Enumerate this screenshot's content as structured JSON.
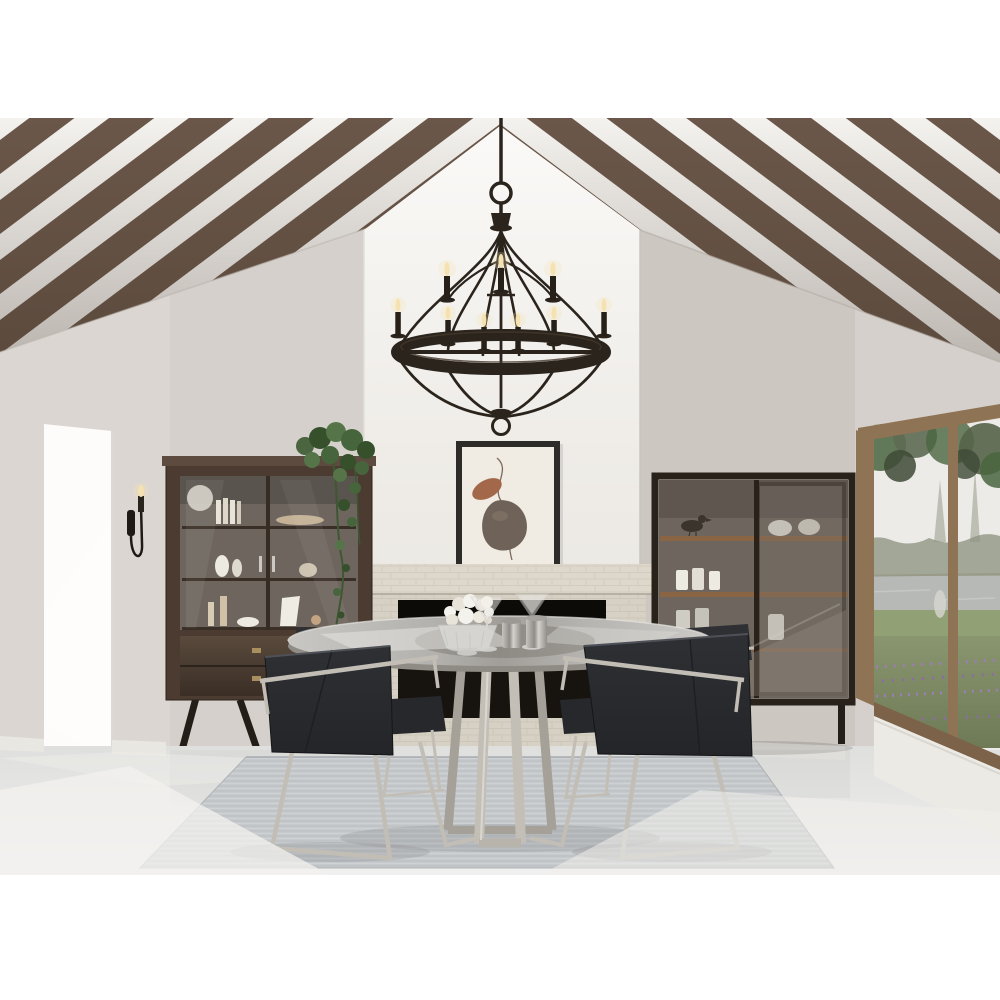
{
  "image": {
    "kind": "product-lifestyle-photo",
    "subject": "Modern farmhouse dining room with a 9-light wrought-iron candle chandelier over a round glass dining table",
    "background": "#ffffff"
  },
  "scene": {
    "objects": [
      "vaulted white ceiling with dark rustic wood beams",
      "9-light black iron two-tier candle chandelier with ring and basket cage",
      "white chimney breast with framed abstract artwork",
      "light stone brick fireplace with black firebox",
      "dark wood display cabinet with glass doors, shelves of decor and two drawers",
      "trailing green houseplant on cabinet",
      "black candle wall sconce",
      "bright open doorway",
      "dark metal-frame glass display cabinet with wood shelves and white ceramics",
      "picture window with wood frame and lake, trees and lavender view",
      "round glass-top dining table with brushed steel base",
      "four charcoal velvet dining armchairs with steel sled frames",
      "gray woven area rug",
      "polished light concrete floor with sunlight patches"
    ],
    "colors": {
      "white": "#ffffff",
      "wall": "#d5d0cb",
      "ceiling": "#f4f2ee",
      "beam": "#6a5749",
      "chimney": "#f7f5f1",
      "stone": "#d6d1c4",
      "mantel": "#ddd8cb",
      "firebox": "#17130e",
      "art_frame": "#2e2c29",
      "art_mat": "#f0ebe3",
      "art_leaf": "#a3684a",
      "art_stone": "#6f6258",
      "wood": "#4b3b30",
      "glass_interior": "#6e665e",
      "shelf_wood": "#8a6544",
      "ceramic": "#edeae2",
      "metal_frame": "#29221b",
      "window_wood": "#8f7355",
      "sky": "#ecebe7",
      "treeline": "#9aa08e",
      "water": "#b6b9b5",
      "grass": "#92a076",
      "lavender": "#9c7eb4",
      "foliage": "#4a6540",
      "doorway": "#fdfcfa",
      "floor": "#dfdfde",
      "rug": "#c6cacc",
      "chair": "#2e3034",
      "steel": "#c2beb6",
      "iron": "#2b241d",
      "glow": "#f5e2b0",
      "baseboard": "#e9e7e2"
    }
  }
}
